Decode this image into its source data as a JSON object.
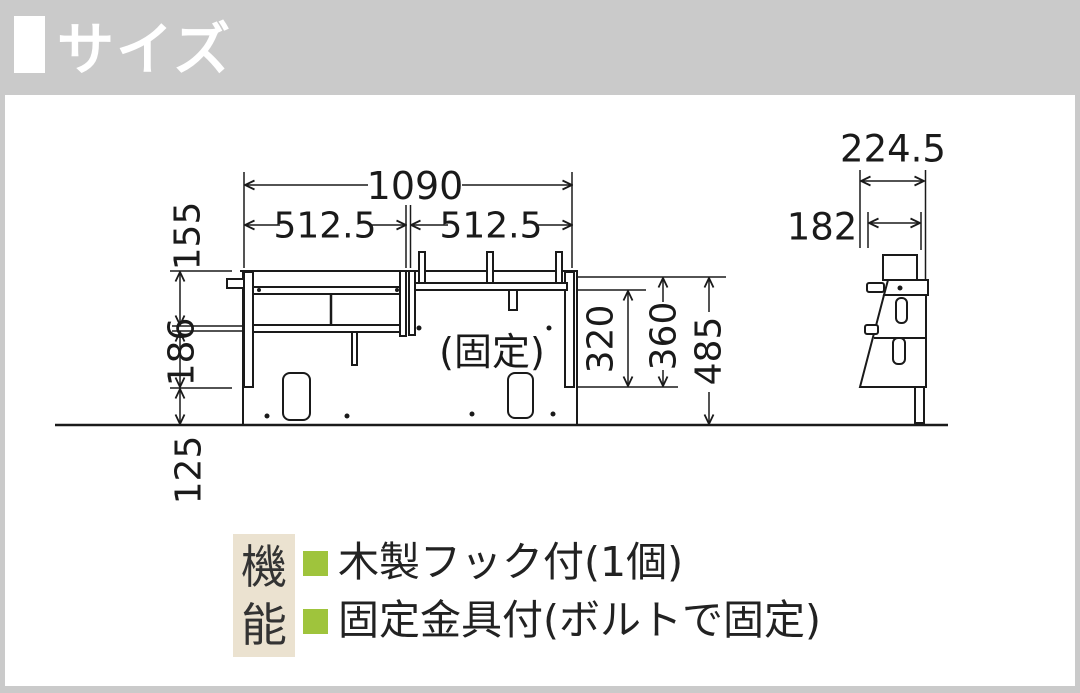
{
  "page": {
    "background": "#cacaca",
    "panel_background": "#ffffff",
    "line_color": "#1a1a1a"
  },
  "header": {
    "title": "サイズ"
  },
  "front_view": {
    "fixed_label": "(固定)",
    "dim_width_total": "1090",
    "dim_width_left": "512.5",
    "dim_width_right": "512.5",
    "dim_height_upper": "155",
    "dim_height_mid": "186",
    "dim_height_lower": "125",
    "dim_height_inner": "320",
    "dim_height_rail": "360",
    "dim_height_total": "485"
  },
  "side_view": {
    "dim_depth_total": "224.5",
    "dim_depth_upper": "182"
  },
  "features": {
    "heading": "機能",
    "heading_bg": "#ebe2d0",
    "bullet_color": "#9fc43c",
    "items": [
      {
        "label": "木製フック付(1個)"
      },
      {
        "label": "固定金具付(ボルトで固定)"
      }
    ]
  }
}
